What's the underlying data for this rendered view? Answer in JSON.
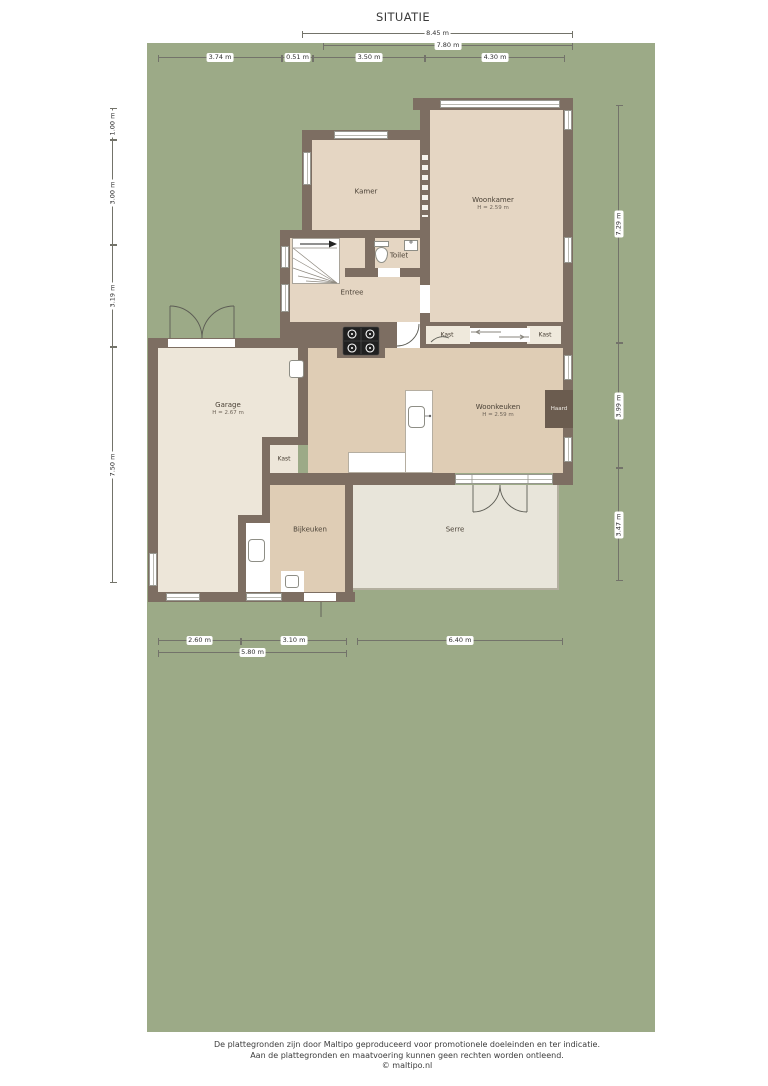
{
  "title": "SITUATIE",
  "rooms": {
    "kamer": {
      "name": "Kamer"
    },
    "woonkamer": {
      "name": "Woonkamer",
      "height": "H = 2.59 m"
    },
    "toilet": {
      "name": "Toilet"
    },
    "entree": {
      "name": "Entree"
    },
    "kast_woonkamer_links": {
      "name": "Kast"
    },
    "kast_woonkamer_rechts": {
      "name": "Kast"
    },
    "garage": {
      "name": "Garage",
      "height": "H = 2.67 m"
    },
    "woonkeuken": {
      "name": "Woonkeuken",
      "height": "H = 2.59 m"
    },
    "haard": {
      "name": "Haard"
    },
    "kast_garage": {
      "name": "Kast"
    },
    "bijkeuken": {
      "name": "Bijkeuken"
    },
    "serre": {
      "name": "Serre"
    }
  },
  "dims": {
    "top": [
      "8.45 m",
      "7.80 m",
      "3.74 m",
      "0.51 m",
      "3.50 m",
      "4.30 m"
    ],
    "left": [
      "1.00 m",
      "3.00 m",
      "3.19 m",
      "7.50 m"
    ],
    "right": [
      "7.29 m",
      "3.99 m",
      "3.47 m"
    ],
    "bottom": [
      "2.60 m",
      "3.10 m",
      "6.40 m",
      "5.80 m"
    ]
  },
  "footer": {
    "line1": "De plattegronden zijn door Maltipo geproduceerd voor promotionele doeleinden en ter indicatie.",
    "line2": "Aan de plattegronden en maatvoering kunnen geen rechten worden ontleend.",
    "line3": "© maltipo.nl"
  },
  "colors": {
    "lot_green": "#9CAA87",
    "wall": "#7D6E62",
    "floor_main": "#E5D6C3",
    "floor_kitchen": "#DFCDB5",
    "floor_garage": "#EDE6D9",
    "floor_serre": "#E8E5DA",
    "floor_niche": "#EFE9DC",
    "haard": "#6B5C4F"
  }
}
